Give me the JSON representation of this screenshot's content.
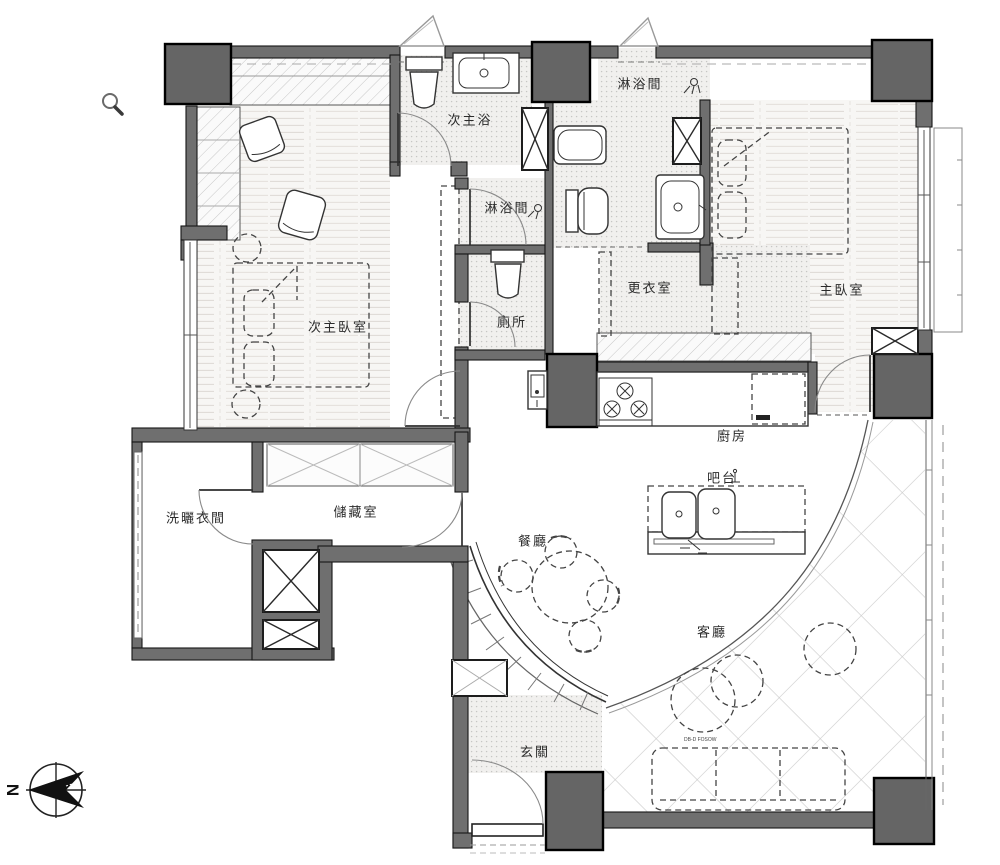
{
  "plan": {
    "title": "apartment floor plan",
    "compass": {
      "label": "N"
    },
    "rooms": [
      {
        "id": "secondary-master-bath",
        "label": "次主浴"
      },
      {
        "id": "shower-room-master",
        "label": "淋浴間"
      },
      {
        "id": "shower-room-secondary",
        "label": "淋浴間"
      },
      {
        "id": "secondary-master-bedroom",
        "label": "次主臥室"
      },
      {
        "id": "toilet-room",
        "label": "廁所"
      },
      {
        "id": "walk-in-closet",
        "label": "更衣室"
      },
      {
        "id": "master-bedroom",
        "label": "主臥室"
      },
      {
        "id": "kitchen",
        "label": "廚房"
      },
      {
        "id": "bar-counter",
        "label": "吧台"
      },
      {
        "id": "laundry-room",
        "label": "洗曬衣間"
      },
      {
        "id": "storage-room",
        "label": "儲藏室"
      },
      {
        "id": "dining-room",
        "label": "餐廳"
      },
      {
        "id": "living-room",
        "label": "客廳"
      },
      {
        "id": "entryway",
        "label": "玄關"
      }
    ],
    "annotations": [
      {
        "id": "sofa-model-code",
        "label": "DB-D FOSOW"
      }
    ],
    "colors": {
      "wall_gray": "#6f6f6f",
      "column_gray": "#656565",
      "line_dark": "#161616",
      "floor_tint": "#f3f2f0"
    }
  }
}
